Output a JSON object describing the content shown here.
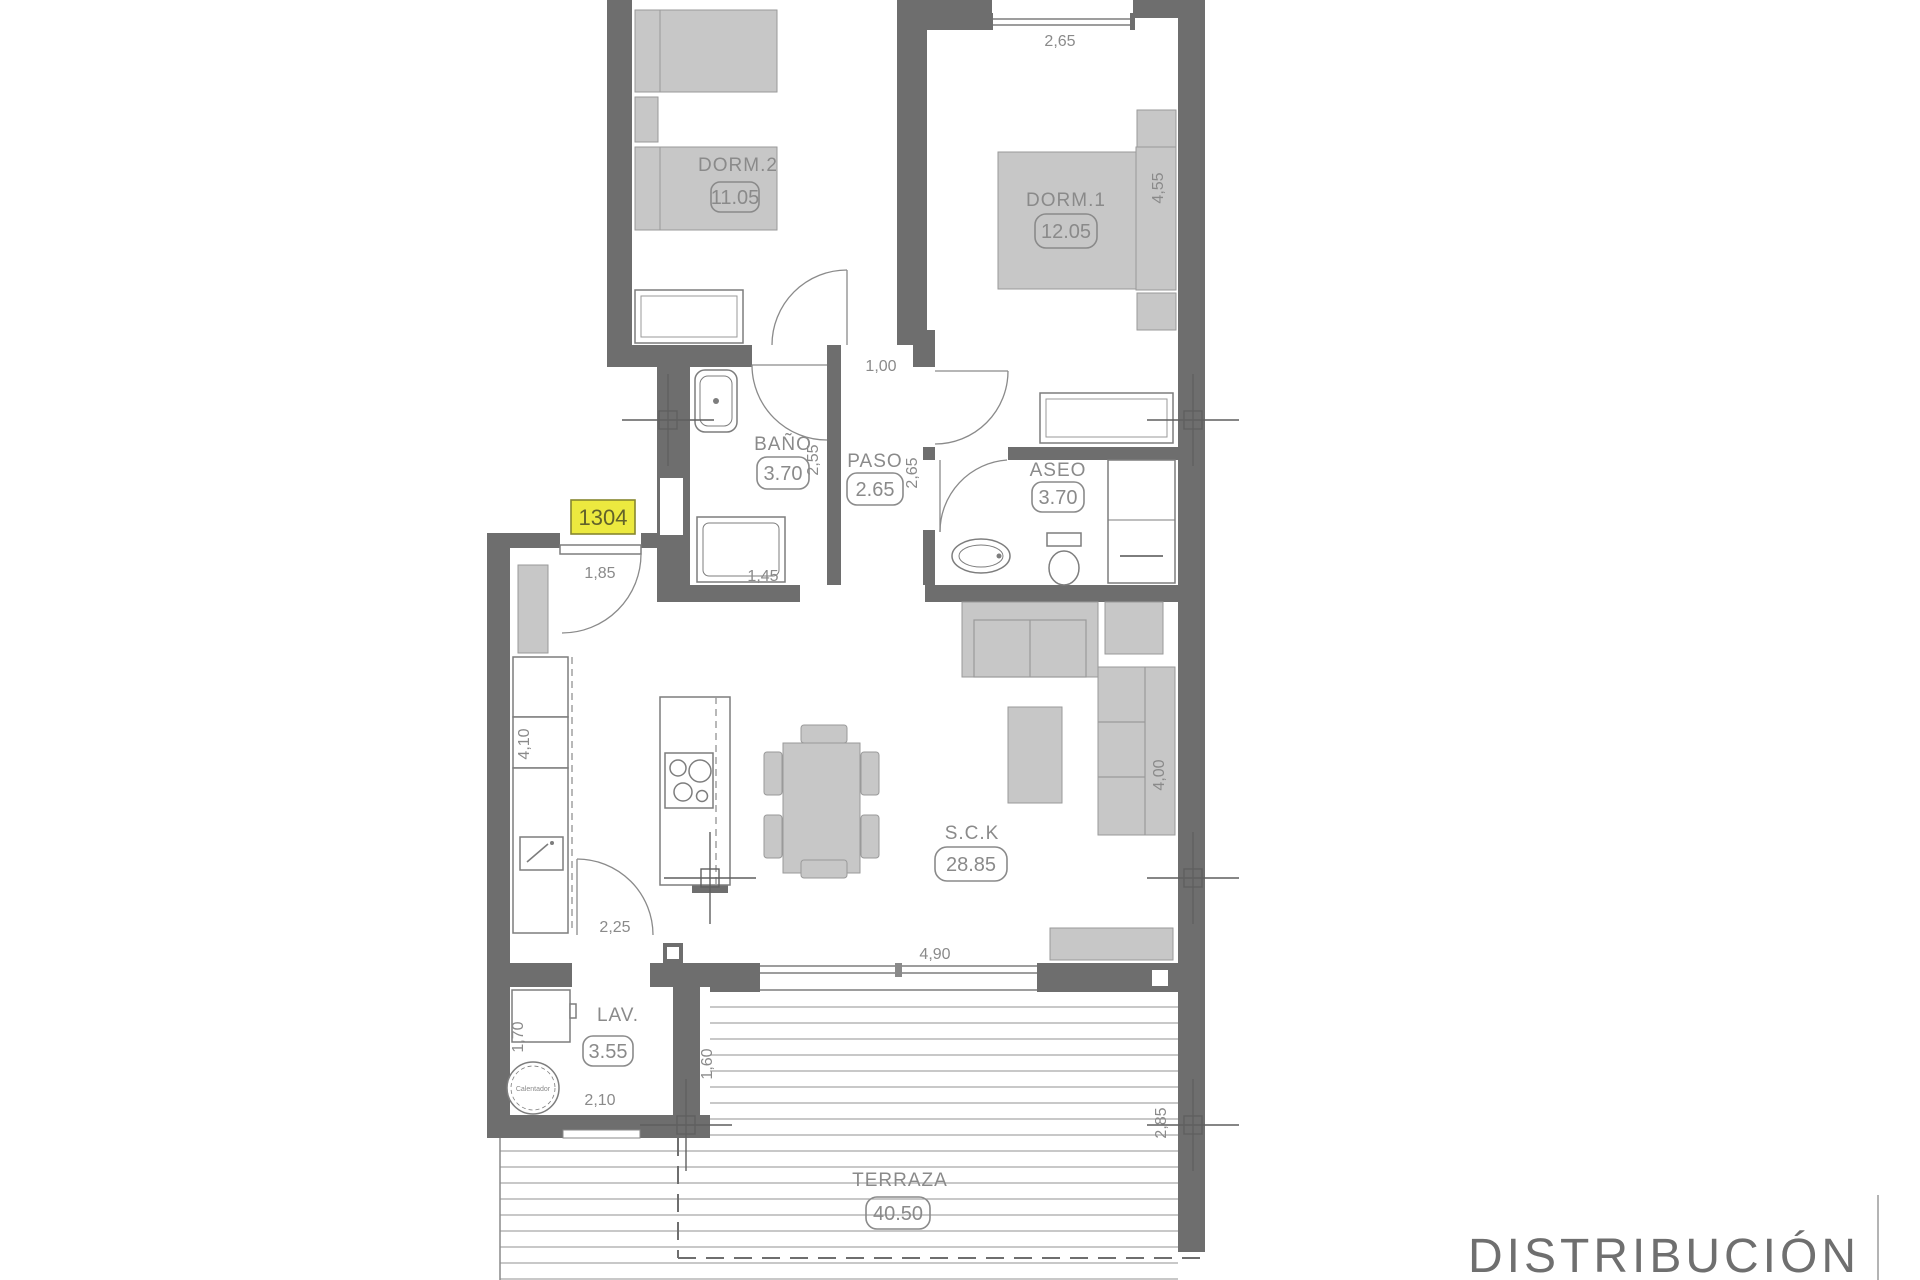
{
  "meta": {
    "sheet_title": "DISTRIBUCIÓN",
    "unit_number": "1304",
    "drawing_type": "apartment floor plan"
  },
  "rooms": [
    {
      "id": "dorm2",
      "name": "DORM.2",
      "area": "11.05"
    },
    {
      "id": "dorm1",
      "name": "DORM.1",
      "area": "12.05"
    },
    {
      "id": "bano",
      "name": "BAÑO",
      "area": "3.70"
    },
    {
      "id": "paso",
      "name": "PASO",
      "area": "2.65"
    },
    {
      "id": "aseo",
      "name": "ASEO",
      "area": "3.70"
    },
    {
      "id": "sck",
      "name": "S.C.K",
      "area": "28.85"
    },
    {
      "id": "lav",
      "name": "LAV.",
      "area": "3.55"
    },
    {
      "id": "terraza",
      "name": "TERRAZA",
      "area": "40.50"
    }
  ],
  "dimensions": {
    "dorm1_width": "2,65",
    "dorm1_depth": "4,55",
    "paso_door": "1,00",
    "bano_depth": "2,55",
    "paso_depth": "2,65",
    "entry_door": "1,85",
    "bath_tub": "1,45",
    "kitchen_depth": "4,10",
    "kitchen_pass": "2,25",
    "living_window": "4,90",
    "sofa_wall": "4,00",
    "lav_left": "1,70",
    "lav_width": "2,10",
    "terraza_offset": "1,60",
    "terraza_right": "2,85"
  },
  "equipment": {
    "water_heater": "Calentador"
  },
  "colors": {
    "wall": "#6e6e6e",
    "furniture": "#c7c7c7",
    "badge_fill": "#ece93f",
    "badge_border": "#87872f",
    "text": "#8a8a8a"
  }
}
